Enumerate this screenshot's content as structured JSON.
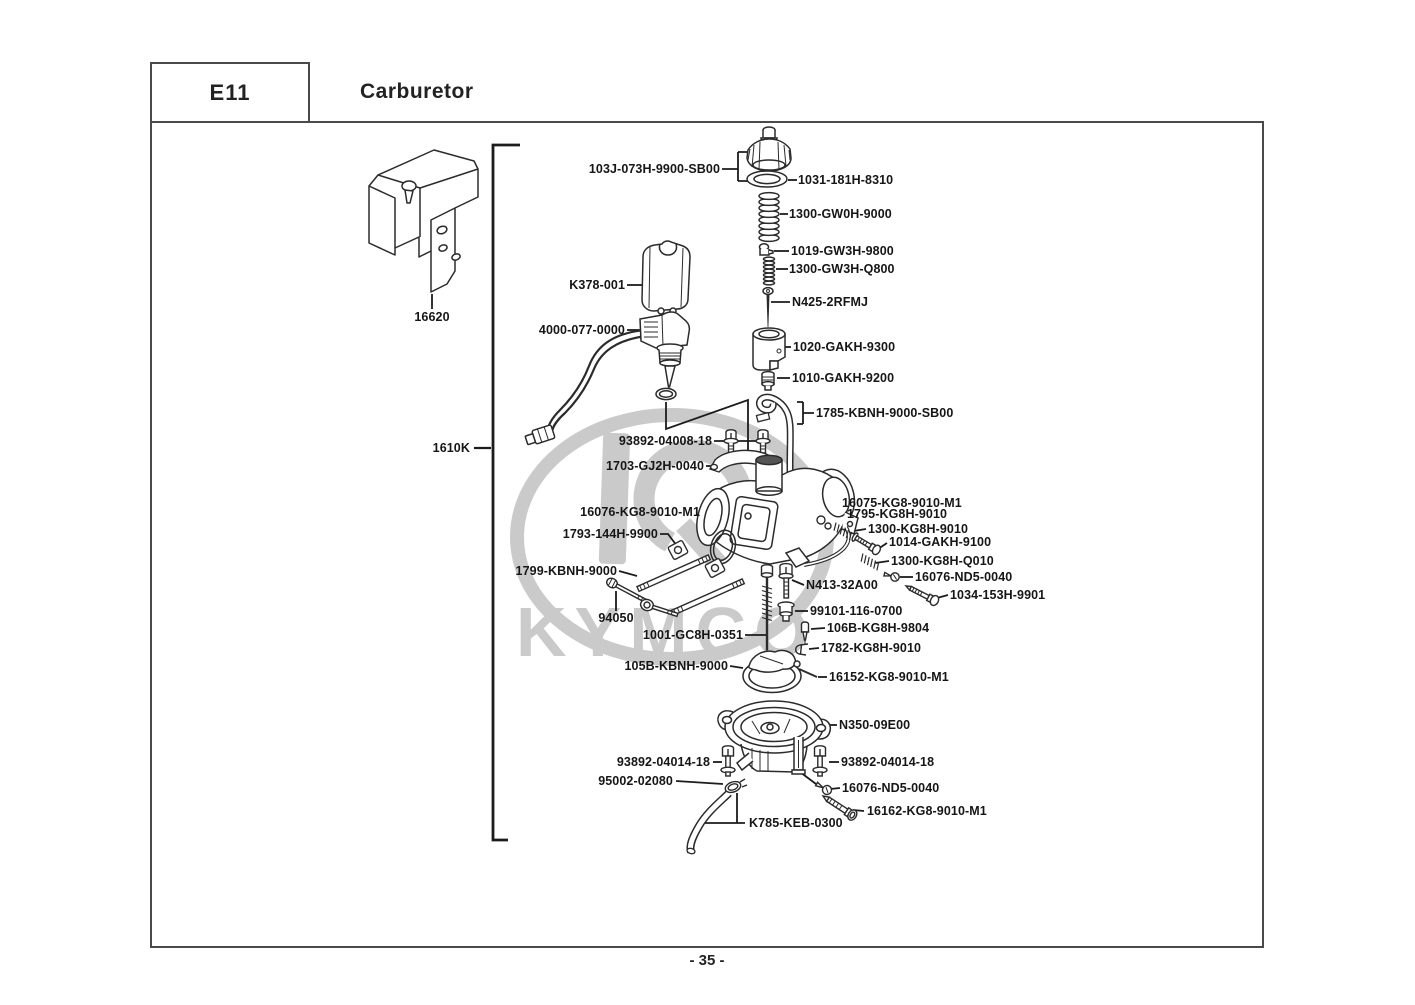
{
  "header": {
    "section_code": "E11",
    "title": "Carburetor"
  },
  "footer": {
    "page_number": "- 35 -"
  },
  "watermark": {
    "brand": "KYMCO"
  },
  "diagram": {
    "labels": [
      {
        "text": "103J-073H-9900-SB00",
        "align": "right",
        "x": 720,
        "y": 169
      },
      {
        "text": "1031-181H-8310",
        "align": "left",
        "x": 798,
        "y": 180
      },
      {
        "text": "1300-GW0H-9000",
        "align": "left",
        "x": 789,
        "y": 214
      },
      {
        "text": "1019-GW3H-9800",
        "align": "left",
        "x": 791,
        "y": 251
      },
      {
        "text": "1300-GW3H-Q800",
        "align": "left",
        "x": 789,
        "y": 269
      },
      {
        "text": "K378-001",
        "align": "right",
        "x": 625,
        "y": 285
      },
      {
        "text": "N425-2RFMJ",
        "align": "left",
        "x": 792,
        "y": 302
      },
      {
        "text": "16620",
        "align": "center",
        "x": 432,
        "y": 317
      },
      {
        "text": "4000-077-0000",
        "align": "right",
        "x": 625,
        "y": 330
      },
      {
        "text": "1020-GAKH-9300",
        "align": "left",
        "x": 793,
        "y": 347
      },
      {
        "text": "1010-GAKH-9200",
        "align": "left",
        "x": 792,
        "y": 378
      },
      {
        "text": "1785-KBNH-9000-SB00",
        "align": "left",
        "x": 816,
        "y": 413
      },
      {
        "text": "93892-04008-18",
        "align": "right",
        "x": 712,
        "y": 441
      },
      {
        "text": "1610K",
        "align": "right",
        "x": 470,
        "y": 448
      },
      {
        "text": "1703-GJ2H-0040",
        "align": "right",
        "x": 704,
        "y": 466
      },
      {
        "text": "16075-KG8-9010-M1",
        "align": "left",
        "x": 842,
        "y": 503
      },
      {
        "text": "16076-KG8-9010-M1",
        "align": "right",
        "x": 700,
        "y": 512
      },
      {
        "text": "1795-KG8H-9010",
        "align": "left",
        "x": 847,
        "y": 514
      },
      {
        "text": "1300-KG8H-9010",
        "align": "left",
        "x": 868,
        "y": 529
      },
      {
        "text": "1793-144H-9900",
        "align": "right",
        "x": 658,
        "y": 534
      },
      {
        "text": "1014-GAKH-9100",
        "align": "left",
        "x": 889,
        "y": 542
      },
      {
        "text": "1300-KG8H-Q010",
        "align": "left",
        "x": 891,
        "y": 561
      },
      {
        "text": "1799-KBNH-9000",
        "align": "right",
        "x": 617,
        "y": 571
      },
      {
        "text": "16076-ND5-0040",
        "align": "left",
        "x": 915,
        "y": 577
      },
      {
        "text": "N413-32A00",
        "align": "left",
        "x": 806,
        "y": 585
      },
      {
        "text": "1034-153H-9901",
        "align": "left",
        "x": 950,
        "y": 595
      },
      {
        "text": "99101-116-0700",
        "align": "left",
        "x": 810,
        "y": 611
      },
      {
        "text": "94050",
        "align": "center",
        "x": 616,
        "y": 618
      },
      {
        "text": "106B-KG8H-9804",
        "align": "left",
        "x": 827,
        "y": 628
      },
      {
        "text": "1001-GC8H-0351",
        "align": "right",
        "x": 743,
        "y": 635
      },
      {
        "text": "1782-KG8H-9010",
        "align": "left",
        "x": 821,
        "y": 648
      },
      {
        "text": "105B-KBNH-9000",
        "align": "right",
        "x": 728,
        "y": 666
      },
      {
        "text": "16152-KG8-9010-M1",
        "align": "left",
        "x": 829,
        "y": 677
      },
      {
        "text": "N350-09E00",
        "align": "left",
        "x": 839,
        "y": 725
      },
      {
        "text": "93892-04014-18",
        "align": "right",
        "x": 710,
        "y": 762
      },
      {
        "text": "93892-04014-18",
        "align": "left",
        "x": 841,
        "y": 762
      },
      {
        "text": "95002-02080",
        "align": "right",
        "x": 673,
        "y": 781
      },
      {
        "text": "16076-ND5-0040",
        "align": "left",
        "x": 842,
        "y": 788
      },
      {
        "text": "16162-KG8-9010-M1",
        "align": "left",
        "x": 867,
        "y": 811
      },
      {
        "text": "K785-KEB-0300",
        "align": "left",
        "x": 749,
        "y": 823
      }
    ]
  }
}
